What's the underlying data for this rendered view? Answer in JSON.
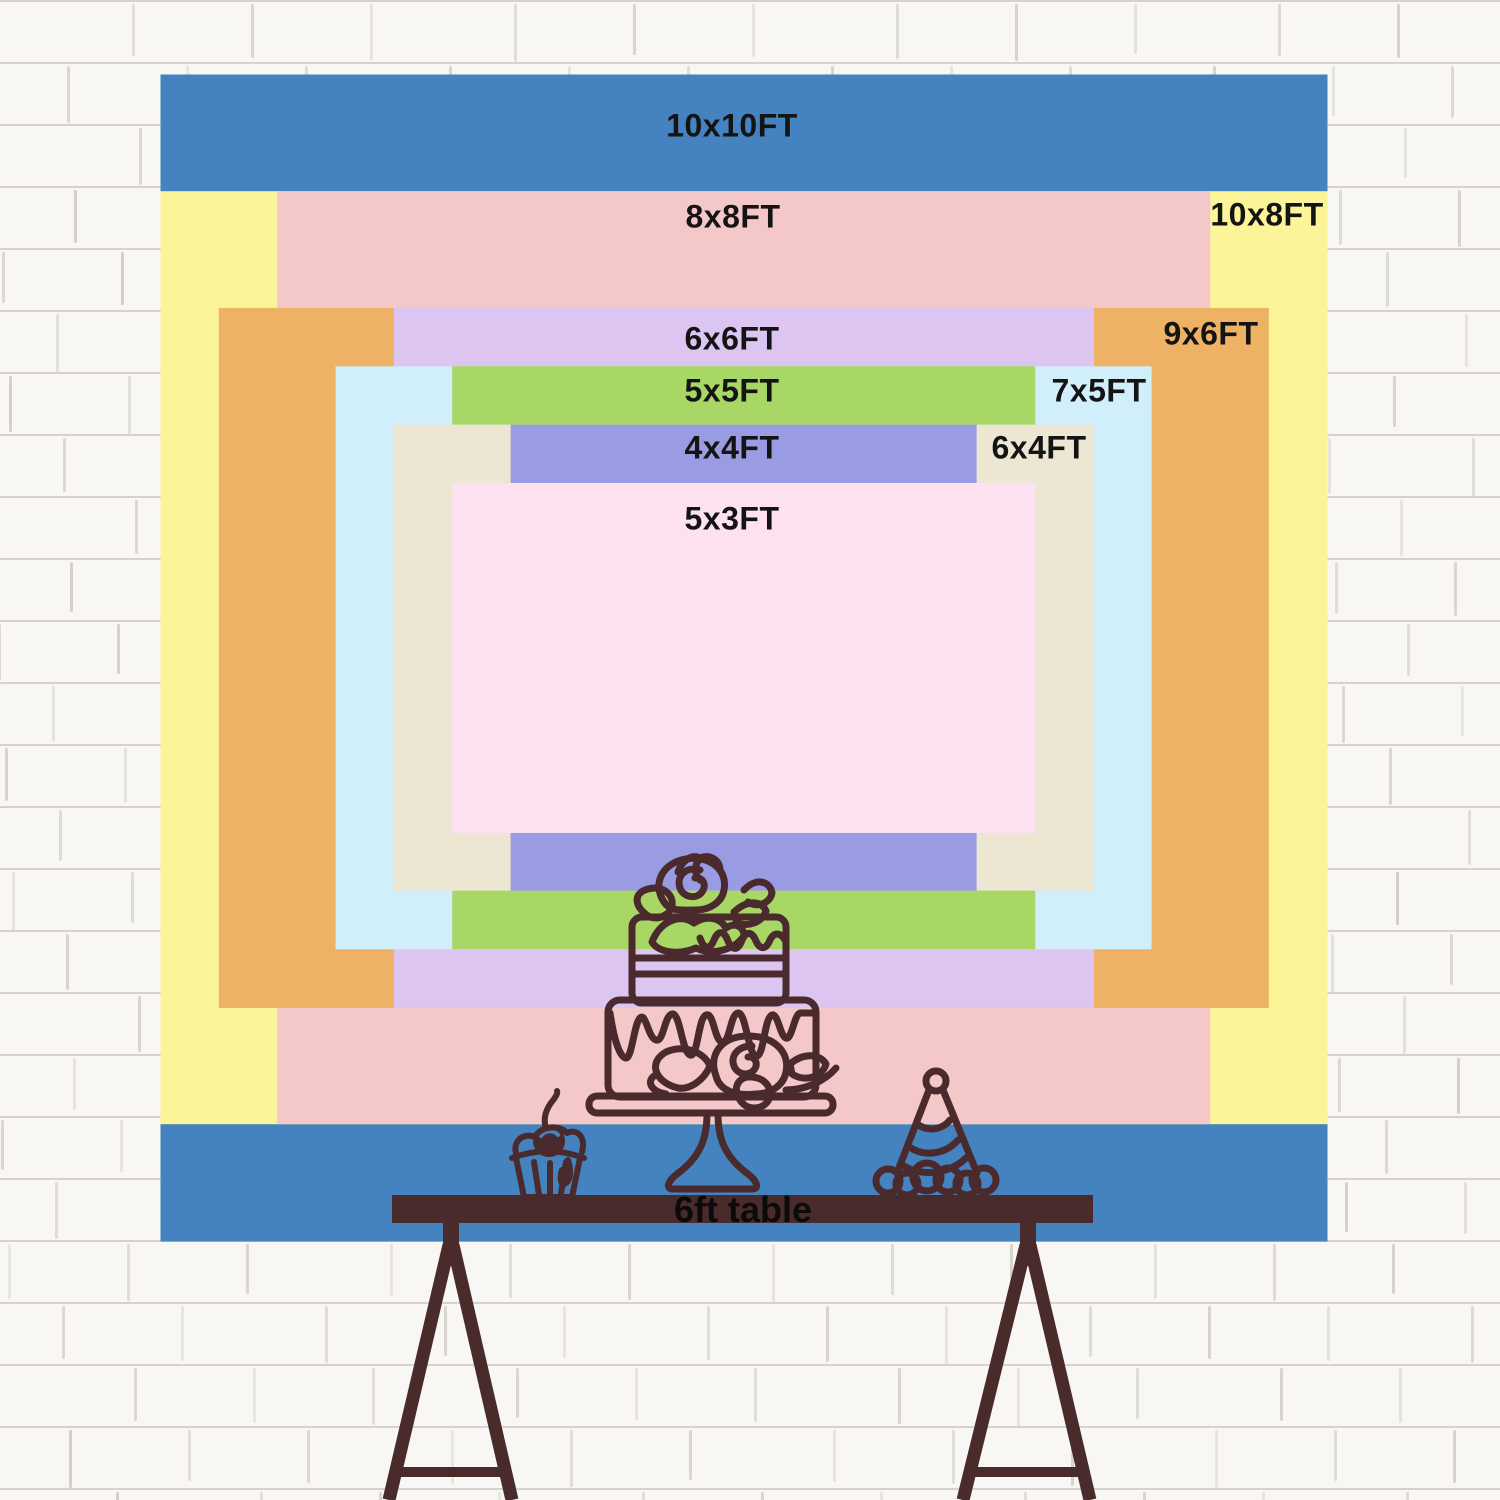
{
  "scene": {
    "description": "backdrop size comparison chart on white brick wall",
    "px_per_ft": 116.7,
    "center_x": 743.5,
    "center_y": 657.5,
    "text_color": "#141414",
    "line_color": "#4A2A2D",
    "wall_color": "#f8f7f4"
  },
  "backdrop": {
    "layers": [
      {
        "name": "10x10ft",
        "label": "10x10FT",
        "width_ft": 10,
        "height_ft": 10,
        "color": "#4483BF",
        "label_x": 732,
        "label_y": 126
      },
      {
        "name": "10x8ft",
        "label": "10x8FT",
        "width_ft": 10,
        "height_ft": 8,
        "color": "#FBF499",
        "label_x": 1267,
        "label_y": 215
      },
      {
        "name": "8x8ft",
        "label": "8x8FT",
        "width_ft": 8,
        "height_ft": 8,
        "color": "#F4C7C8",
        "label_x": 733,
        "label_y": 217
      },
      {
        "name": "9x6ft",
        "label": "9x6FT",
        "width_ft": 9,
        "height_ft": 6,
        "color": "#EDB263",
        "label_x": 1211,
        "label_y": 334
      },
      {
        "name": "6x6ft",
        "label": "6x6FT",
        "width_ft": 6,
        "height_ft": 6,
        "color": "#DCC5F1",
        "label_x": 732,
        "label_y": 339
      },
      {
        "name": "7x5ft",
        "label": "7x5FT",
        "width_ft": 7,
        "height_ft": 5,
        "color": "#D1EFFA",
        "label_x": 1099,
        "label_y": 391
      },
      {
        "name": "5x5ft",
        "label": "5x5FT",
        "width_ft": 5,
        "height_ft": 5,
        "color": "#A8D766",
        "label_x": 732,
        "label_y": 391
      },
      {
        "name": "6x4ft",
        "label": "6x4FT",
        "width_ft": 6,
        "height_ft": 4,
        "color": "#ECE6D2",
        "label_x": 1039,
        "label_y": 448
      },
      {
        "name": "4x4ft",
        "label": "4x4FT",
        "width_ft": 4,
        "height_ft": 4,
        "color": "#9A9CE3",
        "label_x": 732,
        "label_y": 448
      },
      {
        "name": "5x3ft",
        "label": "5x3FT",
        "width_ft": 5,
        "height_ft": 3,
        "color": "#FDE1F1",
        "label_x": 732,
        "label_y": 519
      }
    ]
  },
  "table": {
    "label": "6ft table",
    "bar_color": "#492B2C"
  },
  "illustrations": {
    "items": [
      "tiered-cake-icon",
      "cupcake-icon",
      "party-hat-icon"
    ],
    "line_color": "#4A2A2D"
  }
}
